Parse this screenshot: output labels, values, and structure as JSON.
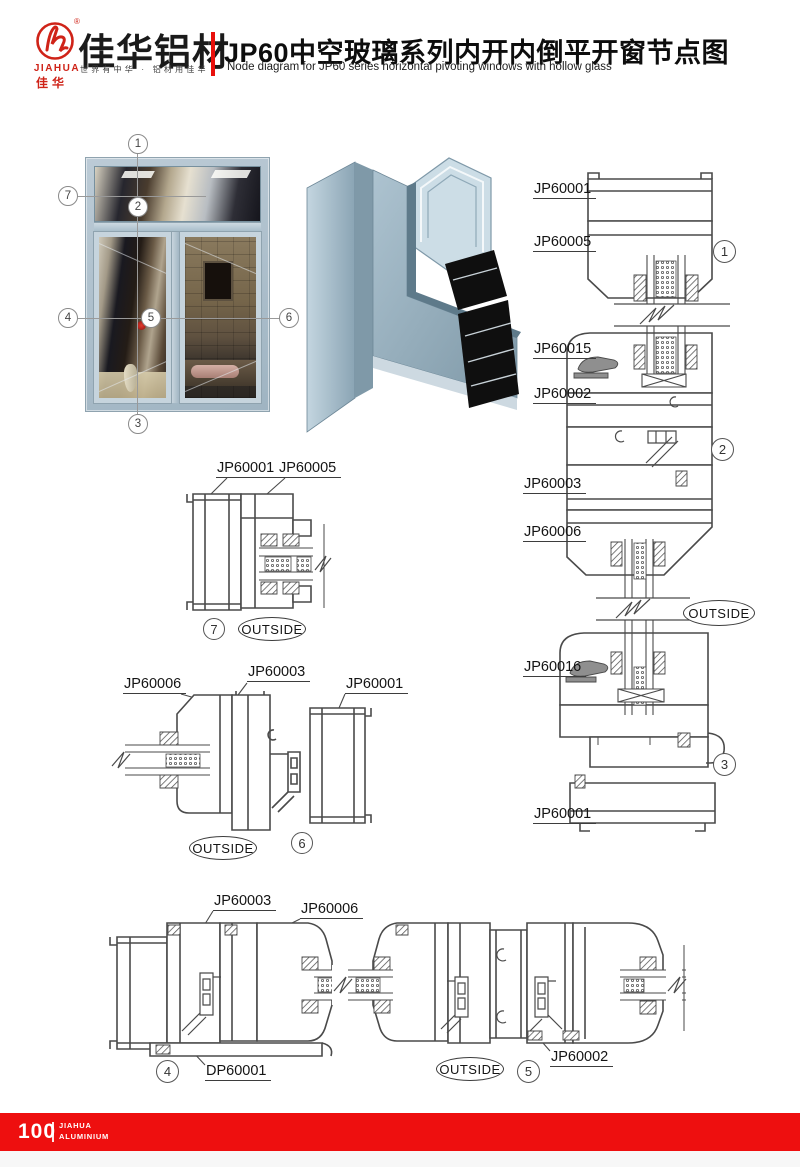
{
  "header": {
    "logo": {
      "registered": "®",
      "brand_en": "JIAHUA",
      "brand_cn_seal": "佳华",
      "brand_name": "佳华铝材",
      "tagline": "世界有中华 · 铝材用佳华"
    },
    "title": "JP60中空玻璃系列内开内倒平开窗节点图",
    "subtitle": "Node diagram for JP60 series horizontal pivoting windows with hollow glass"
  },
  "window": {
    "callouts": [
      "1",
      "2",
      "3",
      "4",
      "5",
      "6",
      "7"
    ]
  },
  "right_column": {
    "labels": [
      "JP60001",
      "JP60005",
      "JP60015",
      "JP60002",
      "JP60003",
      "JP60006",
      "JP60016",
      "JP60001"
    ],
    "callouts": [
      "1",
      "2",
      "3"
    ],
    "outside": "OUTSIDE"
  },
  "detail7": {
    "labels": [
      "JP60001",
      "JP60005"
    ],
    "callout": "7",
    "outside": "OUTSIDE"
  },
  "detail6": {
    "labels": [
      "JP60006",
      "JP60003",
      "JP60001"
    ],
    "callout": "6",
    "outside": "OUTSIDE"
  },
  "bottom": {
    "labels": [
      "JP60003",
      "JP60006",
      "DP60001",
      "JP60002"
    ],
    "callouts": [
      "4",
      "5"
    ],
    "outside": "OUTSIDE"
  },
  "footer": {
    "page_number": "100",
    "brand_line1": "JIAHUA",
    "brand_line2": "ALUMINIUM"
  },
  "colors": {
    "accent_red": "#e8100c",
    "footer_red": "#ee0f0f",
    "line": "#4a4a4a",
    "aluminum": "#a9bfcc"
  }
}
